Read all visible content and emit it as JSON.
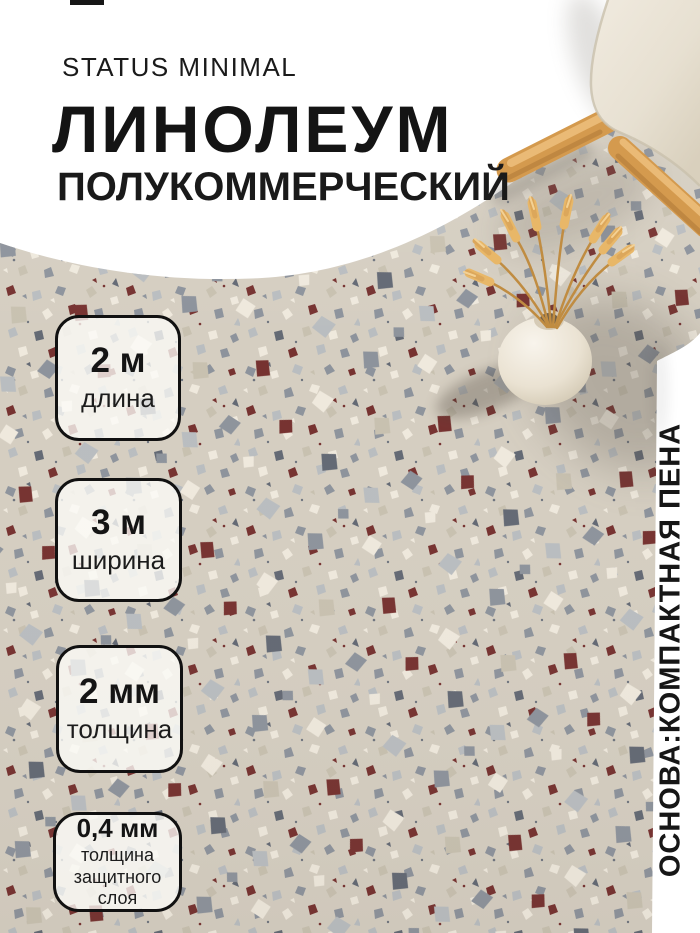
{
  "brand": "STATUS MINIMAL",
  "title": "ЛИНОЛЕУМ",
  "subtitle": "ПОЛУКОММЕРЧЕСКИЙ",
  "badges": [
    {
      "value": "2 м",
      "label": "длина"
    },
    {
      "value": "3 м",
      "label": "ширина"
    },
    {
      "value": "2 мм",
      "label": "толщина"
    },
    {
      "value": "0,4 мм",
      "label": "толщина защитного слоя"
    }
  ],
  "side_label": "ОСНОВА:КОМПАКТНАЯ ПЕНА",
  "colors": {
    "text": "#1a1a1a",
    "background": "#ffffff",
    "floor_base": "#d5cec1",
    "chip_gray": "#8d939c",
    "chip_light_gray": "#b9bdc0",
    "chip_slate": "#636974",
    "chip_maroon": "#763230",
    "chip_white": "#efe9dd",
    "chip_taupe": "#c8c1b0",
    "wood": "#d49a4e",
    "seat": "#eae3d4",
    "wheat": "#e8b768"
  }
}
